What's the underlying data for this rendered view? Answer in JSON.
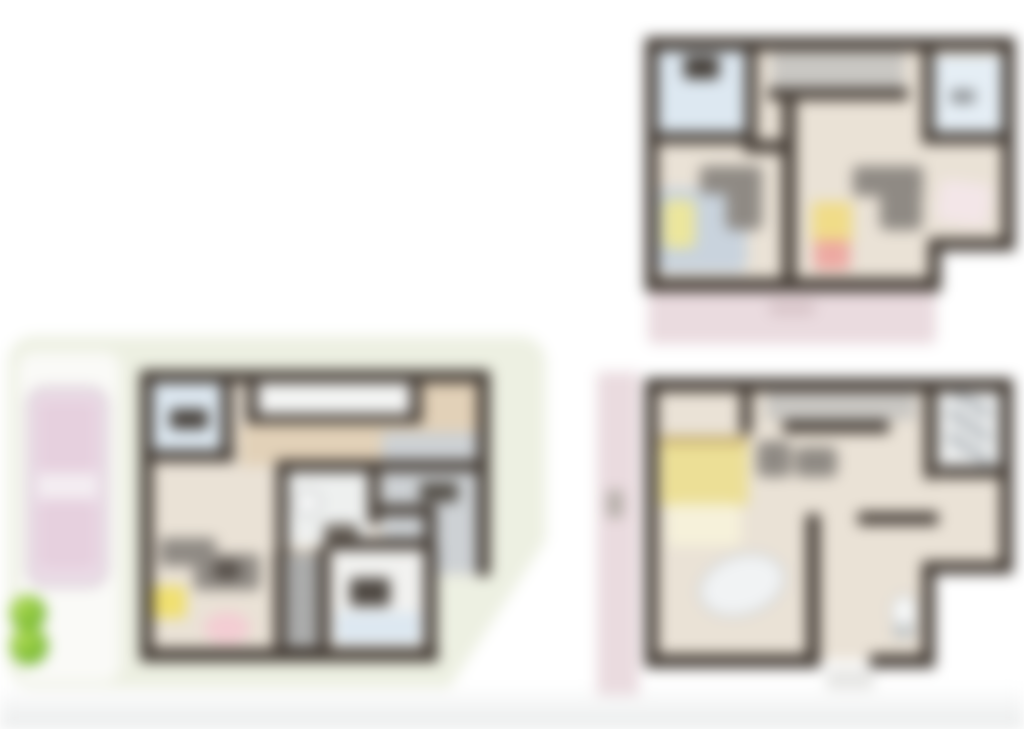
{
  "render": {
    "blur_px": 7,
    "canvas_width": 1024,
    "canvas_height": 729,
    "background": "#ffffff"
  },
  "colors": {
    "wall": "#463e37",
    "floor_beige": "#eae2d6",
    "floor_tan": "#e2d1b8",
    "room_blue": "#dde8f1",
    "balcony_gray": "#c9c7c3",
    "porch_pink": "#eadbdf",
    "ground_green": "#edf0e2",
    "driveway_white": "#fafaf7",
    "car_pink": "#ecdde8",
    "car_roof": "#e6d0de",
    "bush_green": "#7dc331",
    "bath_gray": "#cdd1d4",
    "bed_blue": "#c9d3dd",
    "bed_yellow": "#ecdf96",
    "furniture_gray": "#8f8a84",
    "accent_yellow": "#f0e070",
    "accent_red": "#eda9a2",
    "label_dark": "#47413b"
  },
  "plans": [
    {
      "id": "plan-top-right",
      "position": "top-right",
      "kind": "blurred floor plan with balcony strip, two blue rooms, furniture, pink porch"
    },
    {
      "id": "plan-bottom-right",
      "position": "bottom-right",
      "kind": "blurred floor plan with pink side strip, yellow bed, oval table"
    },
    {
      "id": "plan-bottom-left",
      "position": "bottom-left",
      "kind": "blurred floor plan on green lot with driveway, pink car and two shrubs"
    }
  ]
}
